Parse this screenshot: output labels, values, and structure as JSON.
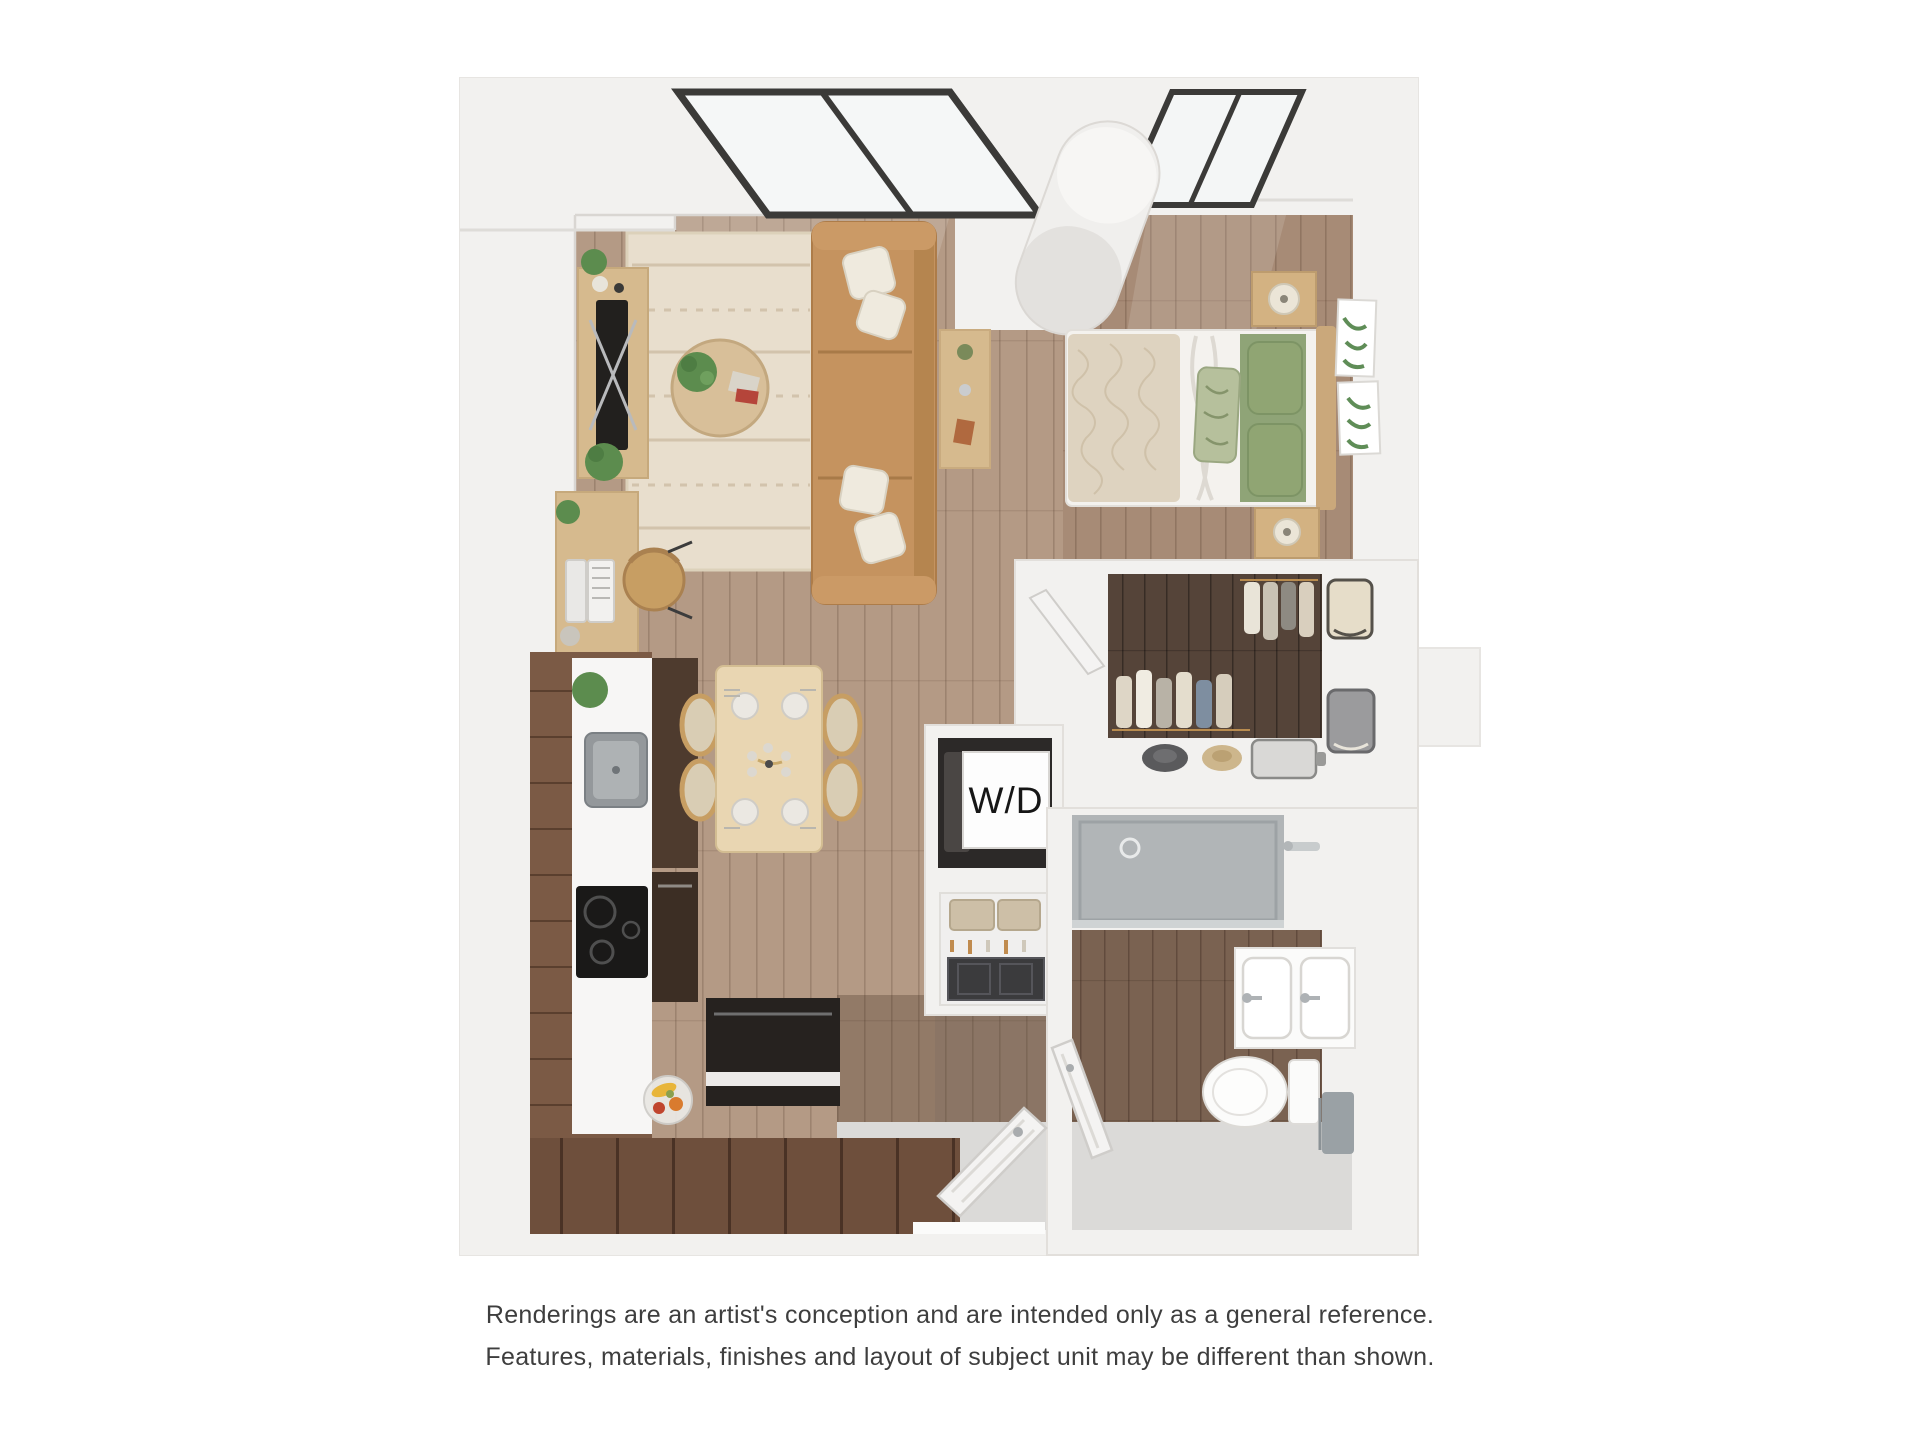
{
  "floorplan": {
    "wd_label": "W/D"
  },
  "disclaimer": {
    "line1": "Renderings are an artist's conception and are intended only as a general reference.",
    "line2": "Features, materials, finishes and layout of subject unit may be different than shown."
  },
  "colors": {
    "page_bg": "#ffffff",
    "wall": "#f2f1ef",
    "wall_shade": "#e7e5e2",
    "floor_light": "#b49a85",
    "floor_bedroom": "#a78b76",
    "floor_closet": "#554439",
    "floor_bath": "#7a6251",
    "floor_gray": "#dbdad8",
    "shower": "#b1b5b7",
    "rug": "#e8decd",
    "rug_pattern": "#d2c3ac",
    "sofa": "#c5935f",
    "pillow": "#efeade",
    "coffee_table": "#d8bf99",
    "console_wood": "#d6ba8e",
    "tv": "#22201e",
    "cabinet": "#7b5a45",
    "counter": "#f7f6f5",
    "sink_metal": "#94989b",
    "cooktop": "#1a1918",
    "island": "#26221f",
    "dining_table": "#e9d6b2",
    "chair": "#c79e63",
    "plate": "#ebe8e2",
    "duvet": "#ded3c0",
    "sheet": "#f4f2ee",
    "blanket": "#8fa477",
    "pillow_green": "#90a573",
    "nightstand": "#d3b282",
    "lamp": "#ebe5d7",
    "art_leaf": "#5f8d57",
    "cylinder": "#f0efed",
    "window_frame": "#3b3a38",
    "glass": "#edf0f0",
    "door": "#f4f3f2",
    "appliance_dark": "#2c2928",
    "wd_card": "#fdfdfd",
    "fixture": "#fbfbfa",
    "towel": "#9aa1a5",
    "plant": "#5c8c4e",
    "text": "#3e3e3e"
  }
}
